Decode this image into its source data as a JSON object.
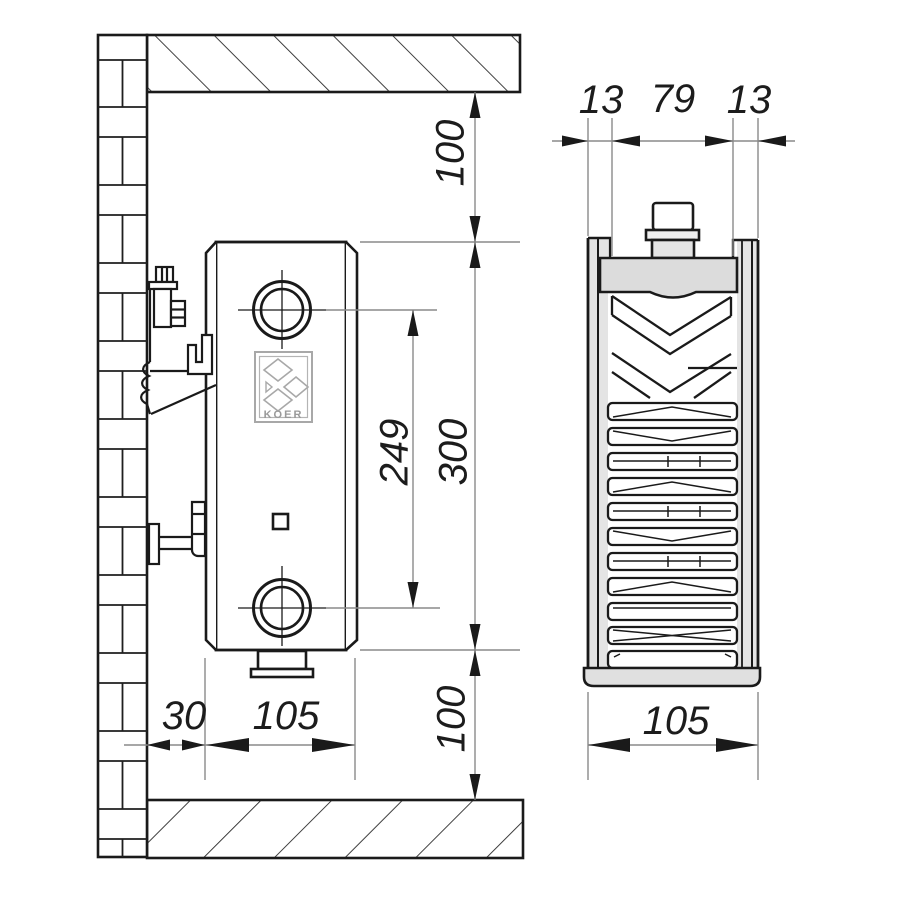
{
  "title": "Radiator installation technical drawing",
  "brand": {
    "logo_text": "KOER"
  },
  "dims": {
    "top_clearance": "100",
    "height": "300",
    "port_spacing": "249",
    "bottom_clearance": "100",
    "wall_offset": "30",
    "depth_side": "105",
    "back_gap": "13",
    "core_width": "79",
    "front_gap": "13",
    "depth_section": "105"
  }
}
